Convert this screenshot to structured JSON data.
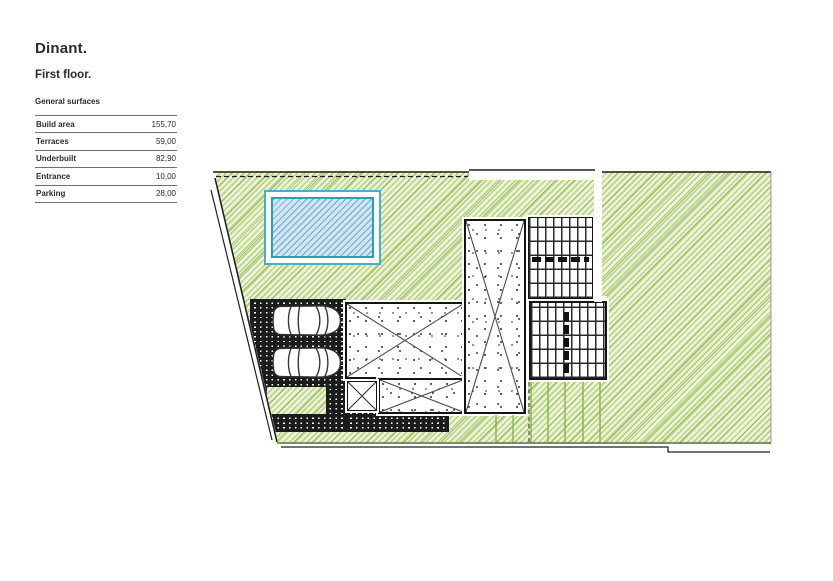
{
  "document": {
    "title": "Dinant.",
    "subtitle": "First floor."
  },
  "surfaces": {
    "heading": "General surfaces",
    "rows": [
      {
        "label": "Build area",
        "value": "155,70"
      },
      {
        "label": "Terraces",
        "value": "59,00"
      },
      {
        "label": "Underbuilt",
        "value": "82,90"
      },
      {
        "label": "Entrance",
        "value": "10,00"
      },
      {
        "label": "Parking",
        "value": "28,00"
      }
    ]
  },
  "plan": {
    "elements": [
      "site-lawn",
      "swimming-pool",
      "parking-pavers",
      "car-top-view",
      "car-top-view",
      "terrace-slab-cross",
      "stair-paving-upper",
      "stair-paving-lower",
      "planter-square",
      "lawn-inset",
      "deck-strip",
      "plot-boundary"
    ]
  },
  "colors": {
    "text": "#262b33",
    "rule": "#6e6e6e",
    "lawn_base": "#eef2d9",
    "lawn_stripe": "#b9d38a",
    "lawn_accent": "#94bf5a",
    "pool_border": "#43b2c6",
    "pool_inner_border": "#2f9db2",
    "pool_fill": "#d3e6f2",
    "pool_stripe": "#7db6d6",
    "paver": "#1b1b1b",
    "line": "#1f1f1f",
    "strip_line": "#86b548",
    "lawn_edge": "#5c7a2e"
  }
}
